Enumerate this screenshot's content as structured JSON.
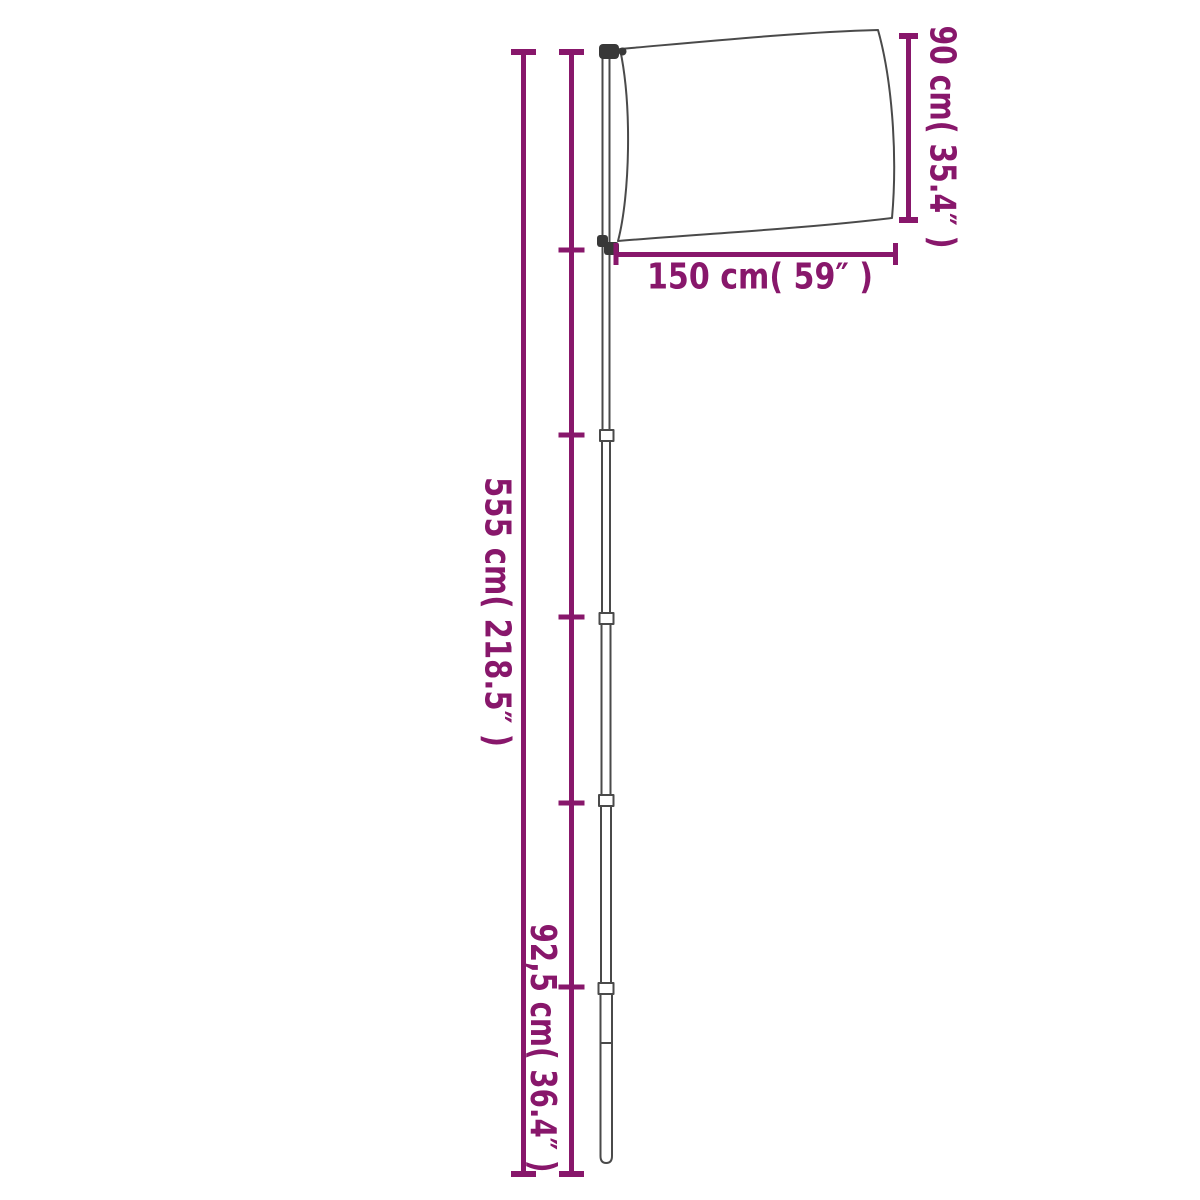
{
  "product": "telescopic-flag-pole-with-flag-dimension-diagram",
  "colors": {
    "dimension_annotation": "#88176B",
    "drawing_outline": "#4A4A4A",
    "hardware_dark": "#383838",
    "background": "#FFFFFF"
  },
  "measurements": {
    "flag_height": {
      "label": "90 cm( 35.4″ )",
      "cm": "90",
      "inch": "35.4"
    },
    "flag_width": {
      "label": "150 cm( 59″ )",
      "cm": "150",
      "inch": "59"
    },
    "pole_height": {
      "label": "555 cm( 218.5″ )",
      "cm": "555",
      "inch": "218.5"
    },
    "pole_section": {
      "label": "92,5 cm( 36.4″ )",
      "cm": "92,5",
      "inch": "36.4"
    }
  }
}
